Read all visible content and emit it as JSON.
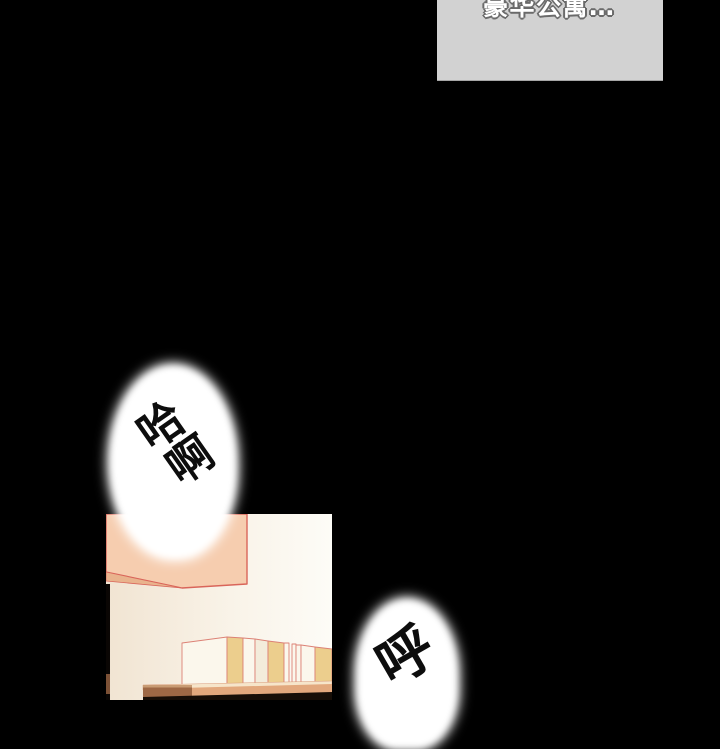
{
  "page": {
    "type": "webtoon-comic-panel"
  },
  "caption_box": {
    "text": "豪华公寓…",
    "note": "text cut off at top edge of screen"
  },
  "speech_bubbles": [
    {
      "id": "haa",
      "text": "哈啊",
      "line1": "哈",
      "line2": "啊"
    },
    {
      "id": "hu",
      "text": "呼",
      "line1": "呼"
    }
  ],
  "panel_scene": {
    "description": "room interior with overhead cabinet and bookshelf with books"
  },
  "palette": {
    "page-bg": "#000000",
    "caption-bg": "#d2d2d2",
    "caption-fg": "#ffffff",
    "caption-outline": "#6a6a6a",
    "bubble-bg": "#ffffff",
    "bubble-fg": "#0d0d0d",
    "wall-left": "#f1e4d2",
    "wall-right": "#fdfcf7",
    "cabinet": "#f6cdaf",
    "cabinet-under": "#e9b38d",
    "line-red": "#d9655a",
    "book-outline": "#dc8175",
    "book-yellow": "#ecce8d",
    "book-white": "#fbf7ec",
    "shelf": "#e2a87d",
    "shelf-bevel": "#f6e5ca",
    "shelf-brown": "#9e6845",
    "shelf-shadow": "#170e07"
  }
}
